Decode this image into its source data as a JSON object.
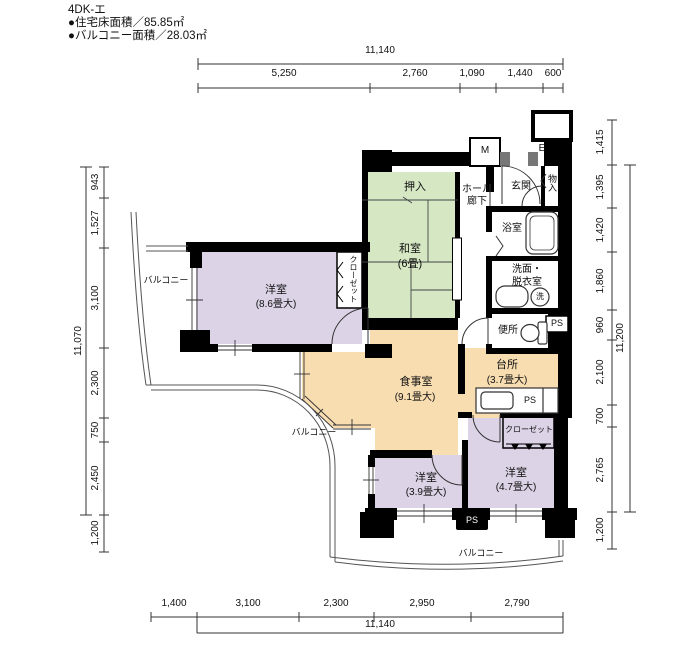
{
  "header": {
    "title": "4DK-エ",
    "area_line1": "●住宅床面積／85.85㎡",
    "area_line2": "●バルコニー面積／28.03㎡"
  },
  "dims": {
    "top": {
      "overall": "11,140",
      "segs": [
        "5,250",
        "2,760",
        "1,090",
        "1,440",
        "600"
      ]
    },
    "bottom": {
      "overall": "11,140",
      "segs": [
        "1,400",
        "3,100",
        "2,300",
        "2,950",
        "2,790"
      ]
    },
    "left": {
      "overall": "11,070",
      "segs": [
        "943",
        "1,527",
        "3,100",
        "2,300",
        "750",
        "2,450",
        "1,200"
      ]
    },
    "right": {
      "overall": "11,200",
      "segs": [
        "1,415",
        "1,395",
        "1,420",
        "1,860",
        "960",
        "2,100",
        "700",
        "2,765",
        "1,200"
      ]
    }
  },
  "rooms": {
    "washitsu": {
      "name": "和室",
      "size": "(6畳)"
    },
    "oshiire": {
      "name": "押入"
    },
    "hall": {
      "line1": "ホール",
      "line2": "廊下"
    },
    "genkan": {
      "name": "玄関"
    },
    "monoire": {
      "name": "物入"
    },
    "bath": {
      "name": "浴室"
    },
    "senmen": {
      "line1": "洗面・",
      "line2": "脱衣室"
    },
    "toilet": {
      "name": "便所"
    },
    "kitchen": {
      "name": "台所",
      "size": "(3.7畳大)"
    },
    "dining": {
      "name": "食事室",
      "size": "(9.1畳大)"
    },
    "bed_main": {
      "name": "洋室",
      "size": "(8.6畳大)"
    },
    "bed_small": {
      "name": "洋室",
      "size": "(3.9畳大)"
    },
    "bed_mid": {
      "name": "洋室",
      "size": "(4.7畳大)"
    },
    "closet_vertical": {
      "name": "クローゼット"
    },
    "closet_horizontal": {
      "name": "クローゼット"
    },
    "balcony_left": {
      "name": "バルコニー"
    },
    "balcony_mid": {
      "name": "バルコニー"
    },
    "balcony_bottom": {
      "name": "バルコニー"
    }
  },
  "labels": {
    "ps": "PS",
    "meter": "M",
    "elevator": "E",
    "washer": "洗"
  },
  "colors": {
    "tatami_green": "#d5e7c3",
    "bedroom_purple": "#dcd3e6",
    "dining_orange": "#f8ddb1",
    "wall_black": "#000000",
    "line_gray": "#555555"
  }
}
